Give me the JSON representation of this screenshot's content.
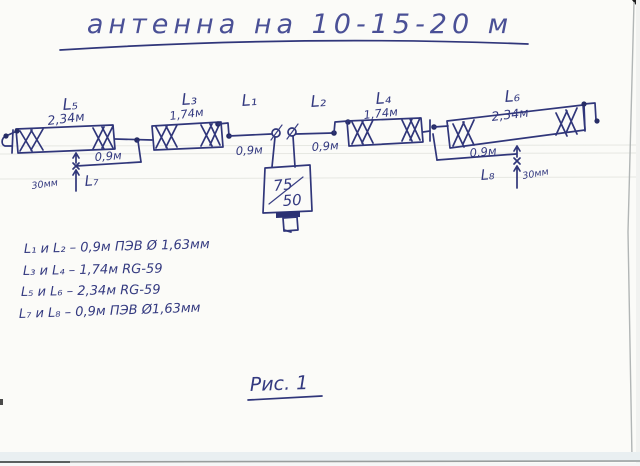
{
  "page": {
    "title": "антенна  на 10-15-20 м",
    "caption": "Рис. 1"
  },
  "diagram": {
    "elements": [
      {
        "name": "L5",
        "label": "L₅",
        "length": "2,34м"
      },
      {
        "name": "L3",
        "label": "L₃",
        "length": "1,74м"
      },
      {
        "name": "L1",
        "label": "L₁",
        "length": "0,9м"
      },
      {
        "name": "L2",
        "label": "L₂",
        "length": "0,9м"
      },
      {
        "name": "L4",
        "label": "L₄",
        "length": "1,74м"
      },
      {
        "name": "L6",
        "label": "L₆",
        "length": "2,34м"
      }
    ],
    "stubs": [
      {
        "name": "L7",
        "label": "L₇",
        "length": "0,9м",
        "offset": "30мм"
      },
      {
        "name": "L8",
        "label": "L₈",
        "length": "0,9м",
        "offset": "30мм"
      }
    ],
    "transformer": {
      "top": "75",
      "bottom": "50"
    }
  },
  "legend": {
    "items": [
      "L₁ и L₂  –  0,9м  ПЭВ Ø 1,63мм",
      "L₃ и L₄  –  1,74м  RG-59",
      "L₅ и L₆  –  2,34м  RG-59",
      "L₇ и L₈  –  0,9м  ПЭВ Ø1,63мм"
    ]
  },
  "colors": {
    "ink": "#30367a",
    "paper": "#fbfbf8"
  }
}
